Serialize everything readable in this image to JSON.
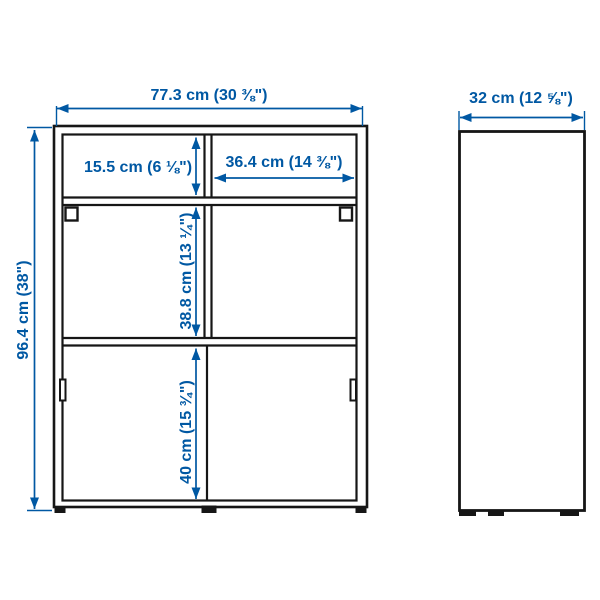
{
  "page": {
    "background": "#ffffff"
  },
  "colors": {
    "dimension_blue": "#0058a3",
    "outline_black": "#161616"
  },
  "diagram": {
    "front_view": {
      "width": "77.3 cm (30 ⅜\")",
      "height": "96.4 cm (38\")",
      "top_shelf_height": "15.5 cm (6 ⅛\")",
      "top_compartment_width": "36.4 cm (14 ⅜\")",
      "middle_compartment_height": "38.8 cm (13 ¼\")",
      "bottom_compartment_height": "40 cm (15 ¾\")"
    },
    "side_view": {
      "depth": "32 cm (12 ⅝\")"
    }
  }
}
